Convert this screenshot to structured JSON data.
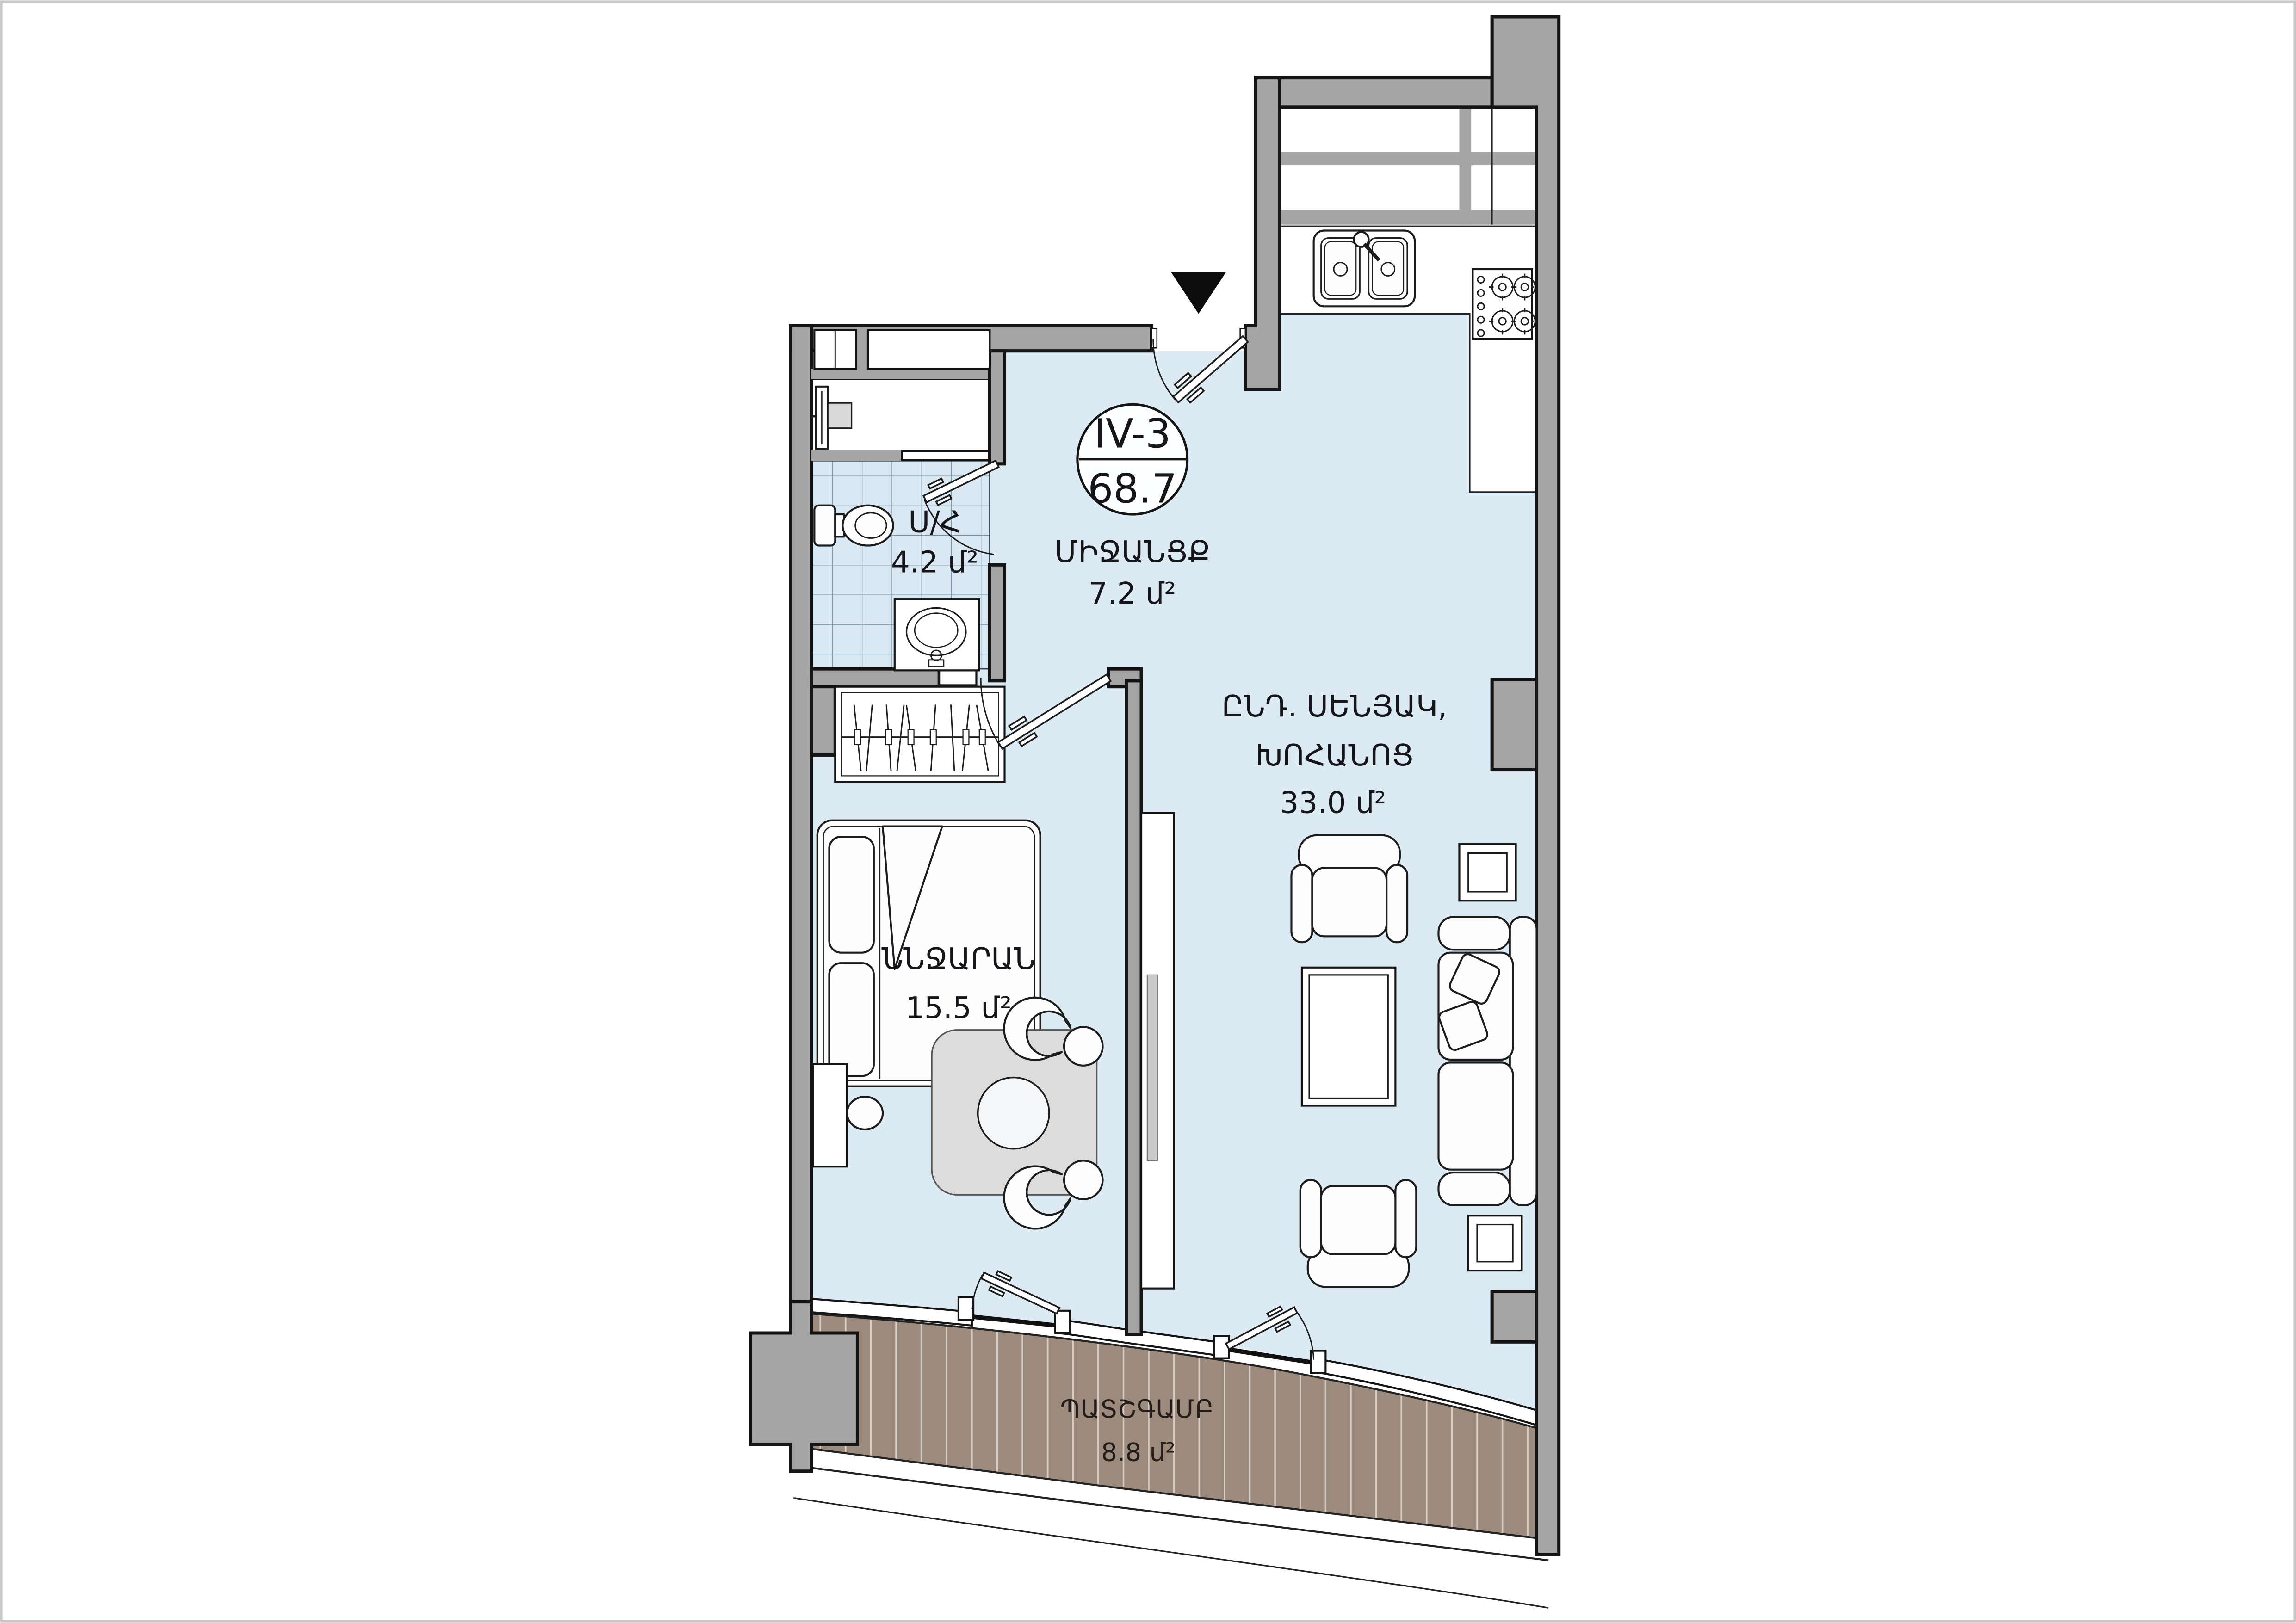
{
  "page": {
    "background": "#ffffff",
    "border_color": "#c6c6c6"
  },
  "plan": {
    "badge": {
      "unit_label": "IV-3",
      "total_area": "68.7"
    },
    "entrance_marker": "entrance-arrow",
    "rooms": {
      "hallway": {
        "name": "ՄԻՋԱՆՑՔ",
        "area": "7.2 մ²"
      },
      "bathroom": {
        "name": "Ս/Հ",
        "area": "4.2 մ²"
      },
      "living_kitchen": {
        "name_line1": "ԸՆԴ. ՍԵՆՅԱԿ,",
        "name_line2": "ԽՈՀԱՆՈՑ",
        "area": "33.0 մ²"
      },
      "bedroom": {
        "name": "ՆՆՋԱՐԱՆ",
        "area": "15.5 մ²"
      },
      "balcony": {
        "name": "ՊԱՏՇԳԱՄԲ",
        "area": "8.8 մ²"
      }
    },
    "colors": {
      "wall": "#a5a5a5",
      "outline": "#141414",
      "floor": "#dceaf4",
      "tile_line": "#6e93a8",
      "deck": "#9c8a7d",
      "deck_line": "#e3d9d1",
      "furniture": "#fdfdfd",
      "rug": "#dcdcdc"
    }
  }
}
